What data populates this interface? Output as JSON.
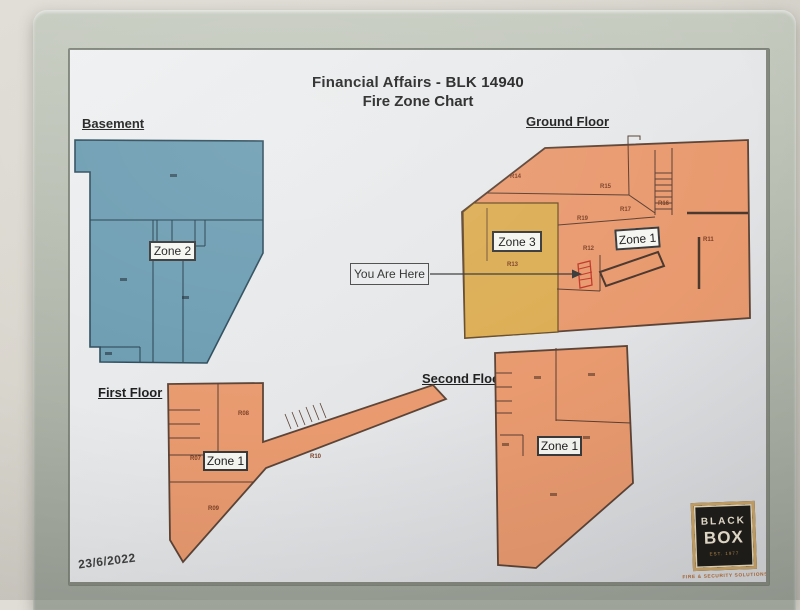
{
  "header": {
    "title_line1": "Financial Affairs - BLK 14940",
    "title_line2": "Fire Zone Chart"
  },
  "floors": {
    "basement": {
      "label": "Basement",
      "zone_label": "Zone 2"
    },
    "ground": {
      "label": "Ground Floor",
      "zone1_label": "Zone 1",
      "zone3_label": "Zone 3",
      "rooms": {
        "r14": "R14",
        "r15": "R15",
        "r16": "R16",
        "r17": "R17",
        "r19": "R19",
        "r12": "R12",
        "r11": "R11",
        "r13": "R13"
      }
    },
    "first": {
      "label": "First Floor",
      "zone_label": "Zone 1",
      "rooms": {
        "r07": "R07",
        "r08": "R08",
        "r09": "R09",
        "r10": "R10"
      }
    },
    "second": {
      "label": "Second Floor",
      "zone_label": "Zone 1"
    }
  },
  "you_are_here": {
    "label": "You Are Here"
  },
  "footer": {
    "date": "23/6/2022"
  },
  "logo": {
    "word1": "BLACK",
    "word2": "BOX",
    "est": "EST. 1977",
    "tagline": "FIRE & SECURITY SOLUTIONS"
  },
  "colors": {
    "wall": "#d8d5cd",
    "frame_silver": "#b4baae",
    "poster": "#e8eaec",
    "basement_fill": "#6d9db2",
    "floor_fill": "#e99a6f",
    "zone3_fill": "#dcae55",
    "marker_red": "#c0392b",
    "outline": "#5d4437"
  }
}
